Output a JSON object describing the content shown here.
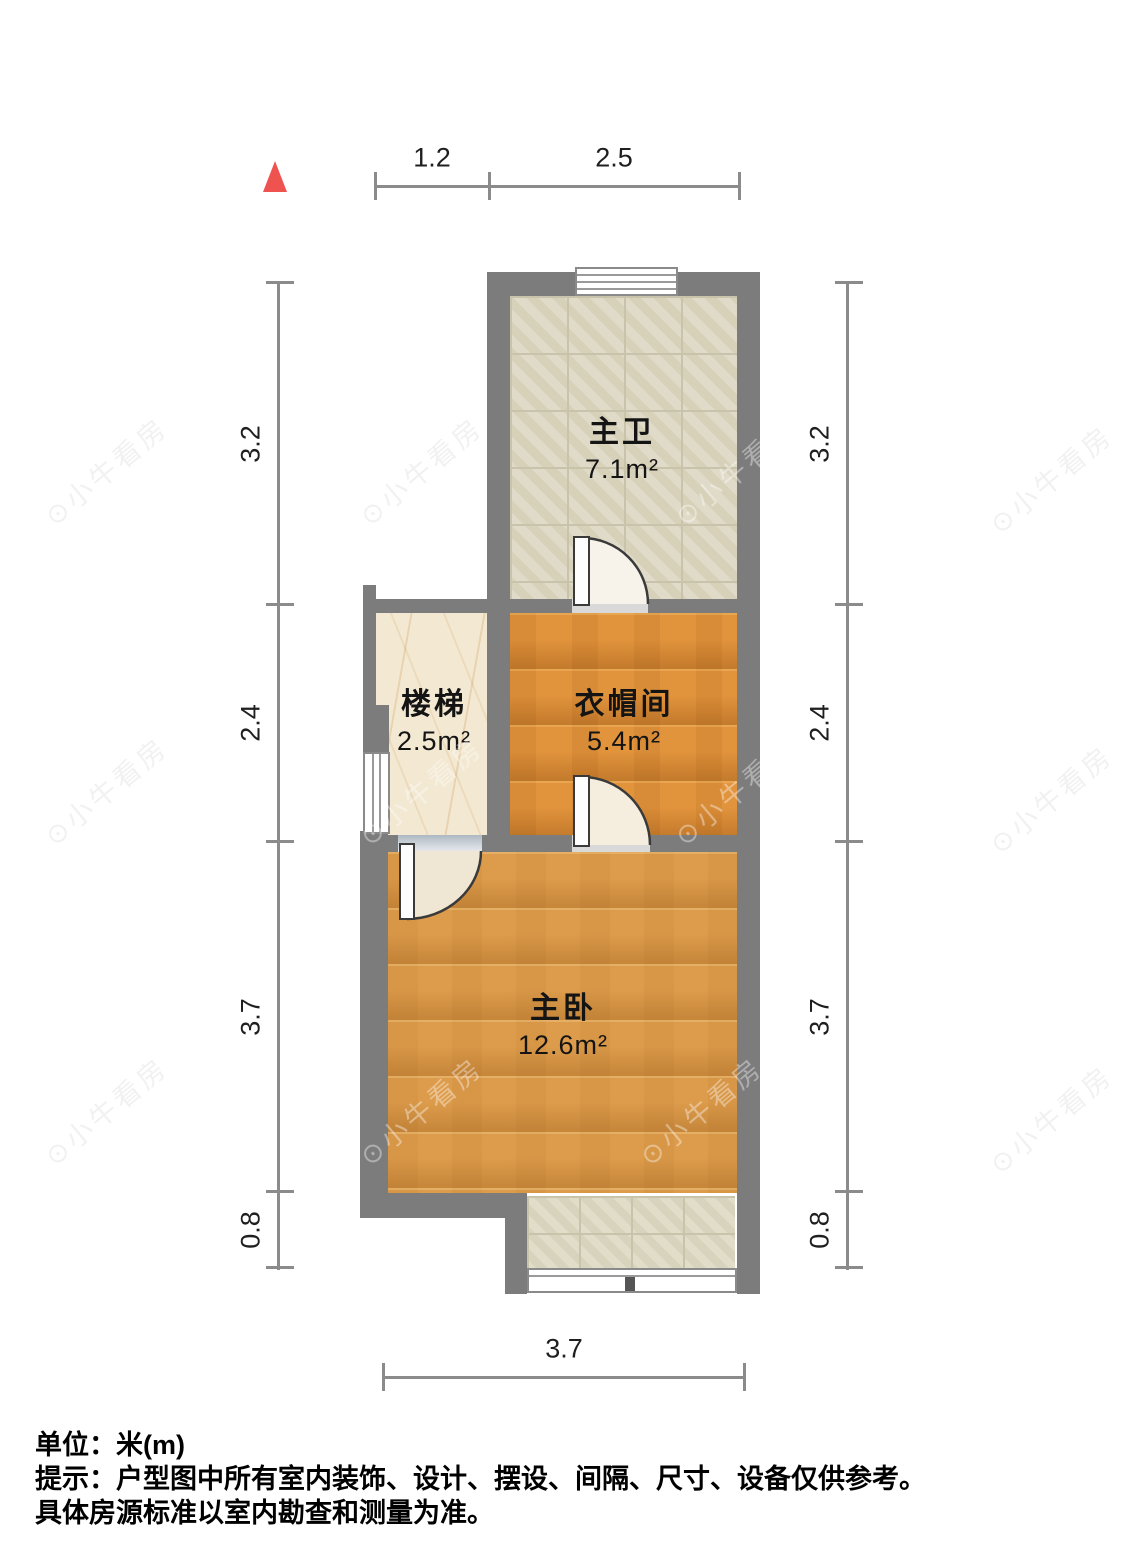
{
  "rooms": [
    {
      "id": "bathroom",
      "name": "主卫",
      "area": "7.1m²"
    },
    {
      "id": "stairs",
      "name": "楼梯",
      "area": "2.5m²"
    },
    {
      "id": "cloakroom",
      "name": "衣帽间",
      "area": "5.4m²"
    },
    {
      "id": "bedroom",
      "name": "主卧",
      "area": "12.6m²"
    }
  ],
  "dimensions": {
    "top": [
      "1.2",
      "2.5"
    ],
    "left": [
      "3.2",
      "2.4",
      "3.7",
      "0.8"
    ],
    "right": [
      "3.2",
      "2.4",
      "3.7",
      "0.8"
    ],
    "bottom": [
      "3.7"
    ]
  },
  "footer": {
    "unit": "单位：米(m)",
    "tip": "提示：户型图中所有室内装饰、设计、摆设、间隔、尺寸、设备仅供参考。",
    "tip2": "具体房源标准以室内勘查和测量为准。"
  },
  "watermark": {
    "icon": "⊙",
    "text": "小牛看房"
  },
  "colors": {
    "wall": "#7c7c7c",
    "wood": "#e2943c",
    "wood_light": "#dd9c4b",
    "tile": "#dcd6c0",
    "marble": "#f3e9d3",
    "north_arrow": "#ef5350",
    "dim_line": "#8b8b8b"
  }
}
